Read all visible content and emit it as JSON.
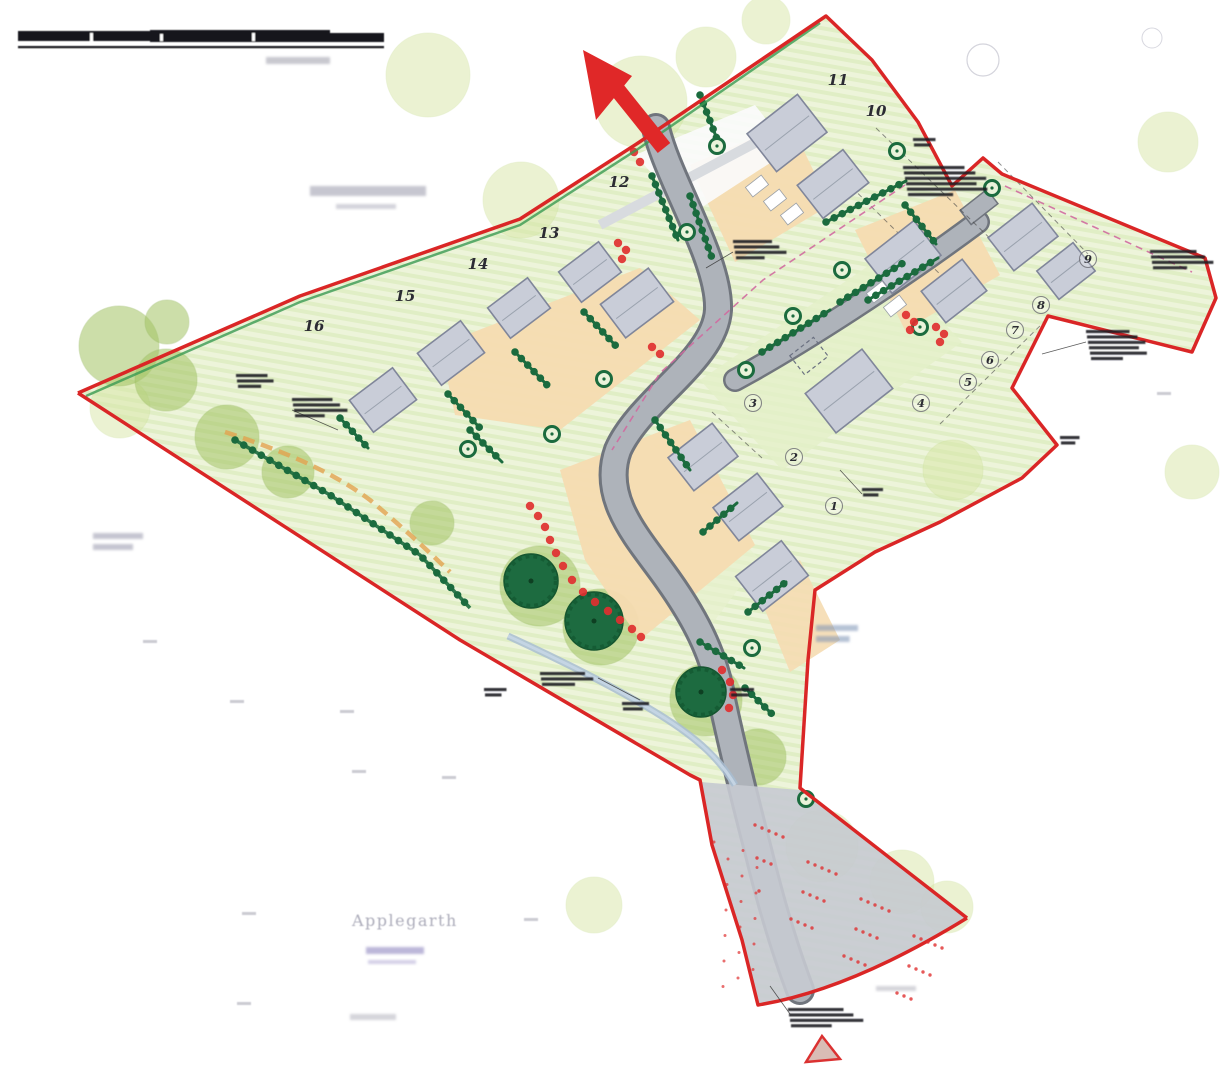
{
  "labels": {
    "applegarth": "Applegarth"
  },
  "colors": {
    "boundary_red": "#da2626",
    "arrow_red": "#e02828",
    "hedge_green": "#1b6b3e",
    "tree_dark_green": "#1d6b40",
    "canopy_mid_green": "#a3c464",
    "canopy_pale_green": "#d8e7a6",
    "site_green": "#edf4da",
    "garden_orange": "#f5dbb1",
    "road_gray": "#aeb3ba",
    "road_casing": "#70757d",
    "building_gray": "#c9cdd8",
    "shrub_red": "#e03030",
    "splay_pink": "#d06aa0",
    "stream_blue": "#a8bdd1",
    "faint_text_gray": "#9e9eae"
  },
  "plots": [
    {
      "n": "1",
      "x": 834,
      "y": 510,
      "c": true
    },
    {
      "n": "2",
      "x": 794,
      "y": 461,
      "c": true
    },
    {
      "n": "3",
      "x": 753,
      "y": 407,
      "c": true
    },
    {
      "n": "4",
      "x": 921,
      "y": 407,
      "c": true
    },
    {
      "n": "5",
      "x": 968,
      "y": 386,
      "c": true
    },
    {
      "n": "6",
      "x": 990,
      "y": 364,
      "c": true
    },
    {
      "n": "7",
      "x": 1015,
      "y": 334,
      "c": true
    },
    {
      "n": "8",
      "x": 1041,
      "y": 309,
      "c": true
    },
    {
      "n": "9",
      "x": 1088,
      "y": 263,
      "c": true
    },
    {
      "n": "10",
      "x": 876,
      "y": 116,
      "c": false
    },
    {
      "n": "11",
      "x": 838,
      "y": 85,
      "c": false
    },
    {
      "n": "12",
      "x": 619,
      "y": 187,
      "c": false
    },
    {
      "n": "13",
      "x": 549,
      "y": 238,
      "c": false
    },
    {
      "n": "14",
      "x": 478,
      "y": 269,
      "c": false
    },
    {
      "n": "15",
      "x": 405,
      "y": 301,
      "c": false
    },
    {
      "n": "16",
      "x": 314,
      "y": 331,
      "c": false
    }
  ],
  "buildings": [
    {
      "x": 383,
      "y": 400,
      "w": 54,
      "h": 40,
      "r": -37
    },
    {
      "x": 451,
      "y": 353,
      "w": 54,
      "h": 40,
      "r": -37
    },
    {
      "x": 519,
      "y": 308,
      "w": 50,
      "h": 38,
      "r": -37
    },
    {
      "x": 590,
      "y": 272,
      "w": 50,
      "h": 38,
      "r": -37
    },
    {
      "x": 637,
      "y": 303,
      "w": 60,
      "h": 42,
      "r": -37
    },
    {
      "x": 787,
      "y": 133,
      "w": 64,
      "h": 48,
      "r": -38
    },
    {
      "x": 833,
      "y": 184,
      "w": 58,
      "h": 42,
      "r": -38
    },
    {
      "x": 903,
      "y": 257,
      "w": 62,
      "h": 44,
      "r": -38
    },
    {
      "x": 954,
      "y": 291,
      "w": 52,
      "h": 40,
      "r": -38
    },
    {
      "x": 1023,
      "y": 237,
      "w": 56,
      "h": 42,
      "r": -38
    },
    {
      "x": 1066,
      "y": 271,
      "w": 46,
      "h": 36,
      "r": -38
    },
    {
      "x": 849,
      "y": 391,
      "w": 72,
      "h": 50,
      "r": -38
    },
    {
      "x": 703,
      "y": 457,
      "w": 56,
      "h": 42,
      "r": -38
    },
    {
      "x": 748,
      "y": 507,
      "w": 56,
      "h": 42,
      "r": -38
    },
    {
      "x": 772,
      "y": 576,
      "w": 58,
      "h": 44,
      "r": -38
    }
  ],
  "garage_dashed": {
    "x": 809,
    "y": 356,
    "w": 30,
    "h": 24,
    "r": -38
  },
  "hedges": [
    [
      448,
      394,
      480,
      428
    ],
    [
      515,
      352,
      548,
      386
    ],
    [
      584,
      312,
      616,
      346
    ],
    [
      340,
      418,
      368,
      448
    ],
    [
      652,
      176,
      678,
      240
    ],
    [
      690,
      196,
      712,
      258
    ],
    [
      700,
      95,
      722,
      152
    ],
    [
      826,
      222,
      906,
      181
    ],
    [
      868,
      300,
      938,
      258
    ],
    [
      655,
      420,
      690,
      470
    ],
    [
      703,
      532,
      737,
      503
    ],
    [
      748,
      612,
      786,
      582
    ],
    [
      700,
      642,
      744,
      668
    ],
    [
      745,
      688,
      772,
      714
    ],
    [
      762,
      352,
      830,
      310
    ],
    [
      840,
      302,
      903,
      263
    ],
    [
      470,
      430,
      502,
      462
    ],
    [
      905,
      205,
      936,
      244
    ]
  ],
  "hedge_arc": [
    [
      235,
      440
    ],
    [
      330,
      495
    ],
    [
      420,
      555
    ],
    [
      470,
      608
    ]
  ],
  "dark_trees": [
    [
      531,
      581,
      27
    ],
    [
      594,
      621,
      29
    ],
    [
      701,
      692,
      25
    ]
  ],
  "mid_canopies": [
    [
      119,
      346,
      40
    ],
    [
      166,
      380,
      31
    ],
    [
      227,
      437,
      32
    ],
    [
      288,
      472,
      26
    ],
    [
      432,
      523,
      22
    ],
    [
      540,
      586,
      40
    ],
    [
      601,
      627,
      38
    ],
    [
      706,
      700,
      36
    ],
    [
      758,
      757,
      28
    ],
    [
      167,
      322,
      22
    ]
  ],
  "pale_canopies": [
    [
      428,
      75,
      42
    ],
    [
      641,
      102,
      46
    ],
    [
      706,
      57,
      30
    ],
    [
      521,
      200,
      38
    ],
    [
      1168,
      142,
      30
    ],
    [
      1192,
      472,
      27
    ],
    [
      953,
      470,
      30
    ],
    [
      822,
      846,
      36
    ],
    [
      902,
      882,
      32
    ],
    [
      947,
      907,
      26
    ],
    [
      594,
      905,
      28
    ],
    [
      120,
      408,
      30
    ],
    [
      766,
      20,
      24
    ]
  ],
  "ring_trees": [
    [
      687,
      232
    ],
    [
      717,
      146
    ],
    [
      604,
      379
    ],
    [
      552,
      434
    ],
    [
      468,
      449
    ],
    [
      746,
      370
    ],
    [
      793,
      316
    ],
    [
      842,
      270
    ],
    [
      897,
      151
    ],
    [
      992,
      188
    ],
    [
      752,
      648
    ],
    [
      806,
      799
    ],
    [
      920,
      327
    ]
  ],
  "shrub_strings": [
    [
      [
        530,
        506
      ],
      [
        538,
        516
      ],
      [
        545,
        527
      ],
      [
        550,
        540
      ],
      [
        556,
        553
      ],
      [
        563,
        566
      ],
      [
        572,
        580
      ],
      [
        583,
        592
      ],
      [
        595,
        602
      ],
      [
        608,
        611
      ],
      [
        620,
        620
      ],
      [
        632,
        629
      ],
      [
        641,
        637
      ]
    ],
    [
      [
        722,
        670
      ],
      [
        730,
        682
      ],
      [
        733,
        695
      ],
      [
        729,
        708
      ]
    ],
    [
      [
        618,
        243
      ],
      [
        626,
        250
      ],
      [
        622,
        259
      ]
    ],
    [
      [
        906,
        315
      ],
      [
        914,
        322
      ],
      [
        910,
        330
      ]
    ],
    [
      [
        936,
        327
      ],
      [
        944,
        334
      ],
      [
        940,
        342
      ]
    ],
    [
      [
        652,
        347
      ],
      [
        660,
        354
      ]
    ],
    [
      [
        634,
        152
      ],
      [
        640,
        162
      ]
    ]
  ],
  "parking_bays": [
    [
      757,
      186
    ],
    [
      775,
      200
    ],
    [
      792,
      214
    ],
    [
      878,
      292
    ],
    [
      895,
      306
    ]
  ],
  "annotation_smudges": [
    [
      733,
      240,
      52,
      4
    ],
    [
      903,
      166,
      82,
      6
    ],
    [
      1150,
      250,
      62,
      4
    ],
    [
      1086,
      330,
      58,
      6
    ],
    [
      236,
      374,
      42,
      3
    ],
    [
      292,
      398,
      54,
      4
    ],
    [
      484,
      688,
      30,
      2
    ],
    [
      540,
      672,
      60,
      3
    ],
    [
      622,
      702,
      36,
      2
    ],
    [
      788,
      1008,
      74,
      4
    ],
    [
      862,
      488,
      28,
      2
    ],
    [
      730,
      688,
      32,
      2
    ],
    [
      1060,
      436,
      26,
      2
    ],
    [
      913,
      138,
      30,
      2
    ]
  ],
  "faint_label_smudges": [
    [
      266,
      57,
      64,
      7,
      1,
      "#9a9aa8",
      0.55
    ],
    [
      310,
      186,
      116,
      10,
      1,
      "#a0a0b0",
      0.6
    ],
    [
      336,
      204,
      60,
      5,
      1,
      "#a8a8b8",
      0.5
    ],
    [
      93,
      533,
      50,
      6,
      2,
      "#9898ab",
      0.55
    ],
    [
      366,
      947,
      58,
      7,
      1,
      "#8f87c0",
      0.6
    ],
    [
      368,
      960,
      48,
      4,
      1,
      "#9f97cc",
      0.45
    ],
    [
      350,
      1014,
      46,
      6,
      1,
      "#a2a2b0",
      0.45
    ],
    [
      816,
      625,
      42,
      6,
      2,
      "#7a8fb5",
      0.55
    ],
    [
      876,
      986,
      40,
      5,
      1,
      "#a2a2b0",
      0.45
    ]
  ],
  "survey_ticks": [
    [
      340,
      710
    ],
    [
      352,
      770
    ],
    [
      442,
      776
    ],
    [
      242,
      912
    ],
    [
      237,
      1002
    ],
    [
      524,
      918
    ],
    [
      143,
      640
    ],
    [
      230,
      700
    ],
    [
      1157,
      392
    ]
  ],
  "leader_lines": [
    [
      733,
      252,
      706,
      268
    ],
    [
      1086,
      342,
      1042,
      354
    ],
    [
      598,
      678,
      640,
      700
    ],
    [
      292,
      410,
      338,
      430
    ],
    [
      790,
      1014,
      770,
      986
    ],
    [
      862,
      494,
      840,
      470
    ]
  ],
  "splay_lines": [
    [
      [
        905,
        185
      ],
      [
        763,
        280
      ],
      [
        660,
        373
      ],
      [
        612,
        450
      ]
    ],
    [
      [
        1005,
        186
      ],
      [
        1192,
        272
      ]
    ]
  ],
  "plot_boundary_dashes": [
    [
      826,
      162,
      950,
      284
    ],
    [
      876,
      128,
      1002,
      250
    ],
    [
      998,
      162,
      1088,
      254
    ],
    [
      940,
      424,
      1046,
      320
    ],
    [
      712,
      412,
      762,
      458
    ]
  ]
}
